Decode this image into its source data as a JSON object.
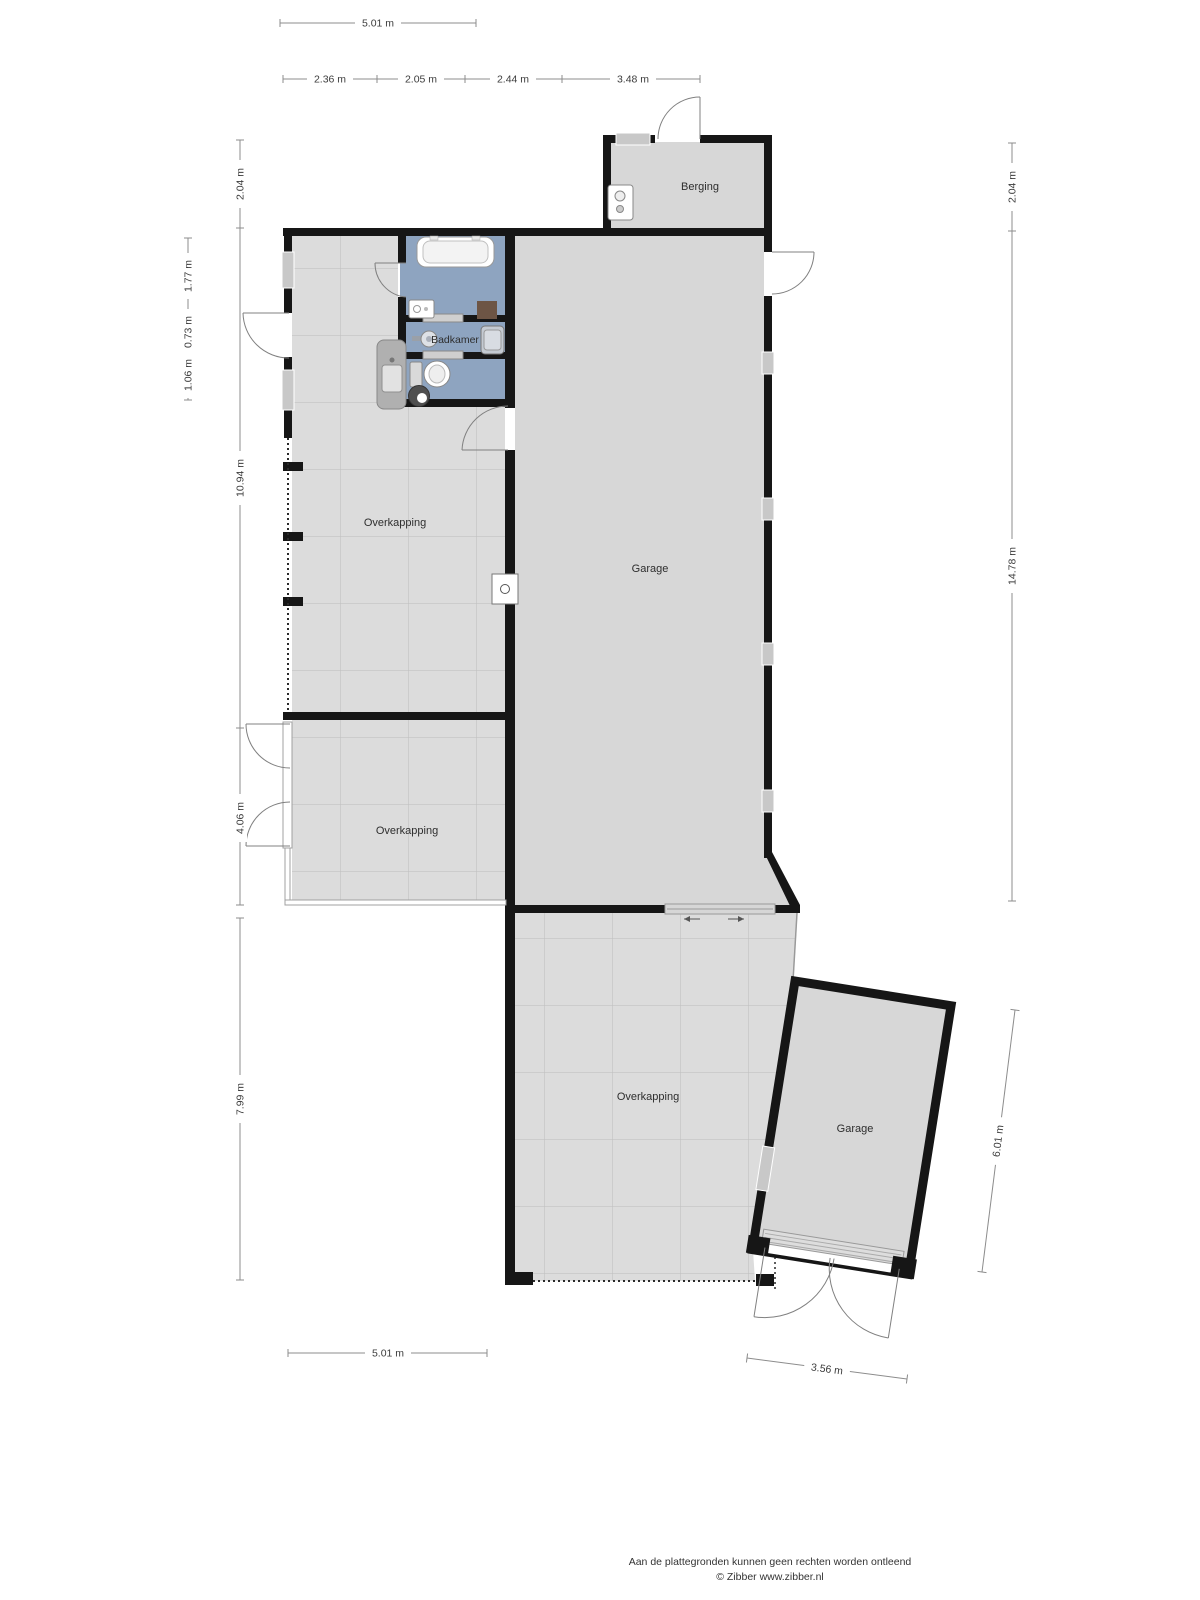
{
  "plan": {
    "type": "floorplan",
    "brand": "Zibber"
  },
  "rooms": {
    "berging": "Berging",
    "badkamer": "Badkamer",
    "overkapping_top": "Overkapping",
    "overkapping_mid": "Overkapping",
    "overkapping_bottom": "Overkapping",
    "garage_main": "Garage",
    "garage_detached": "Garage"
  },
  "dim": {
    "top_total": "5.01 m",
    "seg1": "2.36 m",
    "seg2": "2.05 m",
    "seg3": "2.44 m",
    "seg4": "3.48 m",
    "left_top": "2.04 m",
    "left_in1": "1.77 m",
    "left_in2": "0.73 m",
    "left_in3": "1.06 m",
    "left_main": "10.94 m",
    "left_mid": "4.06 m",
    "left_low": "7.99 m",
    "right_top": "2.04 m",
    "right_main": "14.78 m",
    "right_garage": "6.01 m",
    "bottom_left": "5.01 m",
    "bottom_garage": "3.56 m"
  },
  "footer": {
    "disclaimer": "Aan de plattegronden kunnen geen rechten worden ontleend",
    "credit": "© Zibber www.zibber.nl"
  },
  "colors": {
    "wall": "#161616",
    "room_fill": "#d7d7d7",
    "tile_fill": "#dcdcdc",
    "tile_line": "#bdbdbd",
    "bathroom_fill": "#8ea4c0",
    "dim_line": "#8c8c8c",
    "dim_text": "#3c3c3c",
    "cabinet_brown": "#6d5545"
  }
}
